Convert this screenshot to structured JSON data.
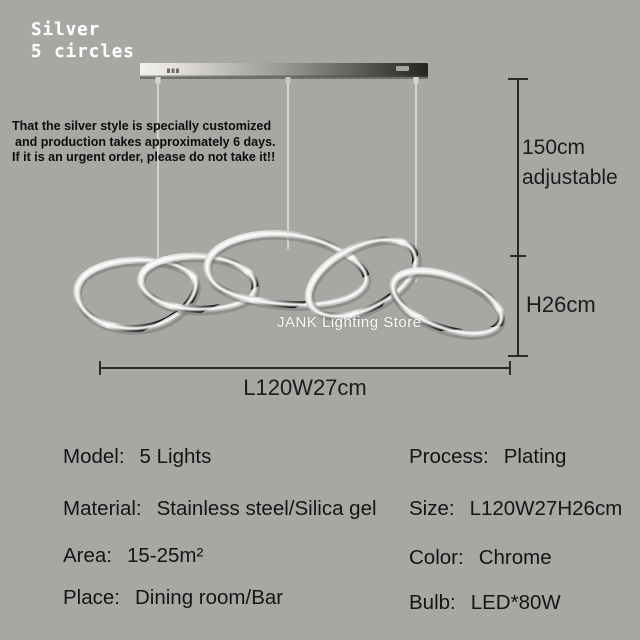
{
  "style_badge": {
    "line1": "Silver",
    "line2": "5 circles"
  },
  "warning": {
    "line1": "That the silver style is specially customized",
    "line2": "and production takes approximately 6 days.",
    "line3": "If it is an urgent order, please do not take it!!"
  },
  "watermark": {
    "text": "JANK Lighting Store"
  },
  "dimensions": {
    "drop_line1": "150cm",
    "drop_line2": "adjustable",
    "height": "H26cm",
    "length_width": "L120W27cm"
  },
  "specs": {
    "left": [
      {
        "label": "Model:",
        "value": "5 Lights"
      },
      {
        "label": "Material:",
        "value": "Stainless steel/Silica gel"
      },
      {
        "label": "Area:",
        "value": "15-25m²"
      },
      {
        "label": "Place:",
        "value": "Dining room/Bar"
      }
    ],
    "right": [
      {
        "label": "Process:",
        "value": "Plating"
      },
      {
        "label": "Size:",
        "value": "L120W27H26cm"
      },
      {
        "label": "Color:",
        "value": "Chrome"
      },
      {
        "label": "Bulb:",
        "value": "LED*80W"
      }
    ]
  },
  "colors": {
    "background": "#a8a7a4",
    "text": "#151515",
    "warning_text": "#0d0d0d",
    "watermark_text": "#ffffff",
    "dimension_line": "#2b2b2b",
    "chrome_highlight": "#ffffff",
    "bar_dark_end": "#26251f"
  }
}
